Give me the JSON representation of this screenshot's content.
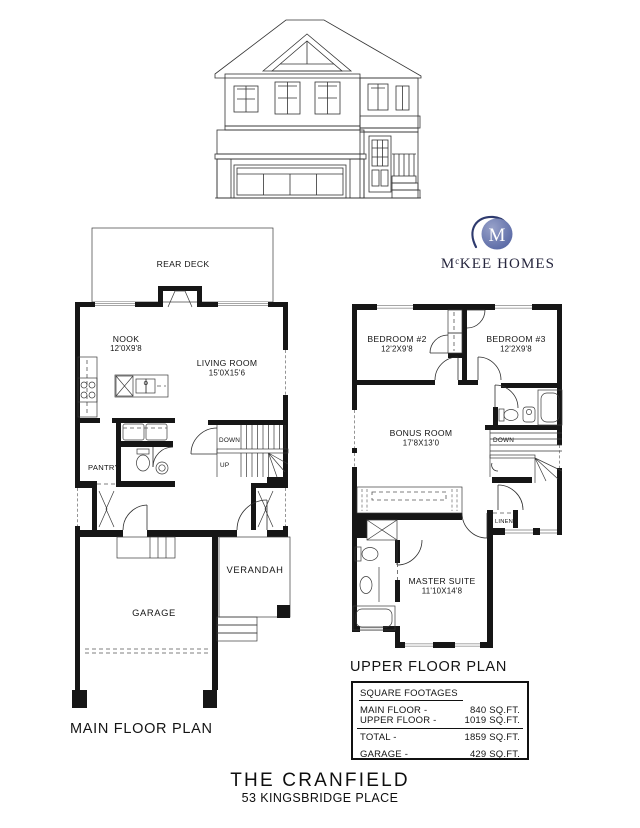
{
  "brand": {
    "monogram": "M",
    "name_m": "M",
    "name_sup": "c",
    "name_rest": "KEE HOMES",
    "circle_color": "#5666a3",
    "circle_hilite": "#97a1c9",
    "swoosh_color": "#2e3a6e"
  },
  "main_floor": {
    "plan_title": "MAIN FLOOR PLAN",
    "labels": {
      "rear_deck": "REAR DECK",
      "nook": "NOOK",
      "nook_dims": "12'0X9'8",
      "living": "LIVING ROOM",
      "living_dims": "15'0X15'6",
      "pantry": "PANTRY",
      "down": "DOWN",
      "up": "UP",
      "verandah": "VERANDAH",
      "garage": "GARAGE"
    }
  },
  "upper_floor": {
    "plan_title": "UPPER FLOOR PLAN",
    "labels": {
      "bedroom2": "BEDROOM #2",
      "bedroom2_dims": "12'2X9'8",
      "bedroom3": "BEDROOM #3",
      "bedroom3_dims": "12'2X9'8",
      "bonus": "BONUS ROOM",
      "bonus_dims": "17'8X13'0",
      "master": "MASTER SUITE",
      "master_dims": "11'10X14'8",
      "linen": "LINEN",
      "down": "DOWN"
    }
  },
  "footages": {
    "title": "SQUARE FOOTAGES",
    "rows": [
      {
        "label": "MAIN FLOOR -",
        "value": "840 SQ.FT."
      },
      {
        "label": "UPPER FLOOR -",
        "value": "1019 SQ.FT."
      },
      {
        "label": "TOTAL -",
        "value": "1859 SQ.FT."
      },
      {
        "label": "GARAGE -",
        "value": "429 SQ.FT."
      }
    ]
  },
  "footer": {
    "title": "THE CRANFIELD",
    "address": "53 KINGSBRIDGE PLACE"
  }
}
